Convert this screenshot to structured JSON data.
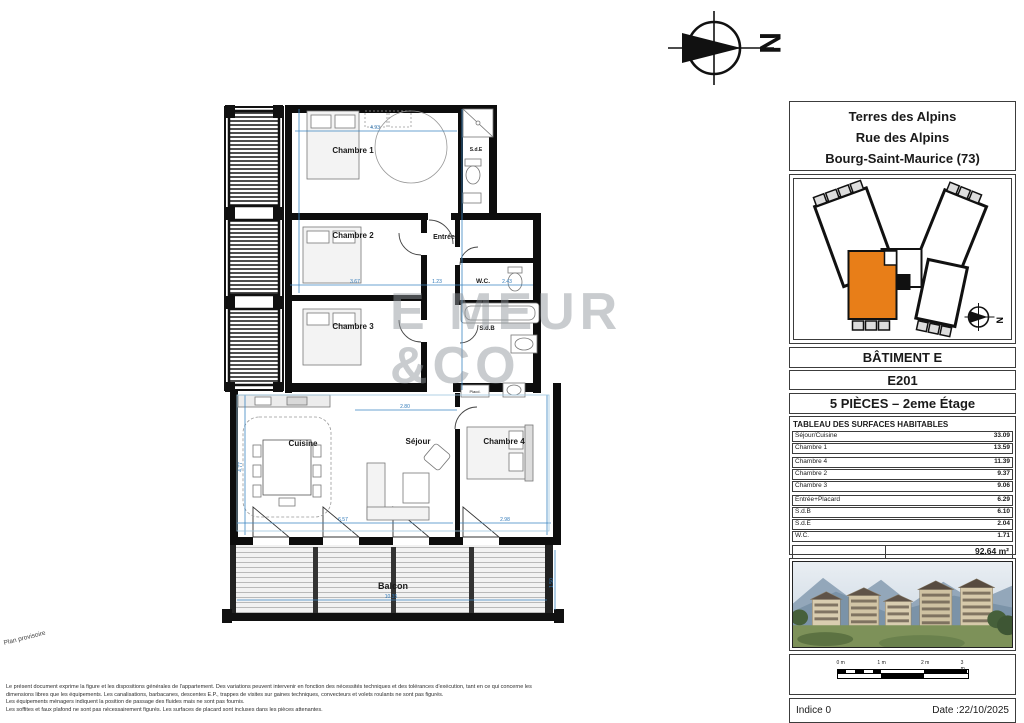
{
  "document": {
    "plan_status_note": "Plan provisoire",
    "disclaimer_lines": [
      "Le présent document exprime la figure et les dispositions générales de l'appartement. Des variations peuvent intervenir en fonction des nécessités techniques et des tolérances d'exécution, tant en ce qui concerne les",
      "dimensions libres que les équipements. Les canalisations, barbacanes, descentes E.P., trappes de visites sur gaines techniques, convecteurs et volets roulants ne sont pas figurés.",
      "Les équipements ménagers indiquent la position de passage des fluides mais ne sont pas fournis.",
      "Les soffites et faux plafond ne sont pas nécessairement figurés. Les surfaces de placard sont incluses dans les pièces attenantes."
    ]
  },
  "north": {
    "letter": "N"
  },
  "watermark": {
    "line1": "E MEUR",
    "line2": "&CO"
  },
  "colors": {
    "accent_orange": "#e87e18",
    "dimension_blue": "#3a85c0"
  },
  "plan": {
    "rooms": {
      "chambre1": "Chambre 1",
      "chambre2": "Chambre 2",
      "chambre3": "Chambre 3",
      "chambre4": "Chambre 4",
      "sejour": "Séjour",
      "cuisine": "Cuisine",
      "entree": "Entrée",
      "wc": "W.C.",
      "sdb": "S.d.B",
      "sde": "S.d.E",
      "balcon": "Balcon",
      "placard": "Placd."
    },
    "dims": [
      "4.93",
      "3.67",
      "1.23",
      "2.43",
      "2.80",
      "4.77",
      "6.57",
      "2.98",
      "1.50",
      "10.35"
    ]
  },
  "titleblock": {
    "project_name": "Terres des Alpins",
    "street": "Rue des Alpins",
    "city": "Bourg-Saint-Maurice (73)",
    "building": "BÂTIMENT E",
    "unit": "E201",
    "type_floor": "5 PIÈCES – 2eme Étage",
    "surfaces": {
      "header": "TABLEAU DES SURFACES HABITABLES",
      "rows": [
        {
          "label": "Séjour/Cuisine",
          "value": "33.09"
        },
        {
          "label": "Chambre 1",
          "value": "13.59"
        },
        {
          "label": "Chambre 4",
          "value": "11.39"
        },
        {
          "label": "Chambre 2",
          "value": "9.37"
        },
        {
          "label": "Chambre 3",
          "value": "9.06"
        },
        {
          "label": "Entrée+Placard",
          "value": "6.29"
        },
        {
          "label": "S.d.B",
          "value": "6.10"
        },
        {
          "label": "S.d.E",
          "value": "2.04"
        },
        {
          "label": "W.C.",
          "value": "1.71"
        }
      ],
      "total": "92.64 m²",
      "balcony_row": {
        "label": "Balcon",
        "value": "16.86"
      },
      "balcony_total": "16.86 m²"
    },
    "scalebar": {
      "labels": [
        "0 m",
        "1 m",
        "2 m",
        "3 m"
      ]
    },
    "footer": {
      "indice": "Indice 0",
      "date": "Date :22/10/2025"
    }
  }
}
